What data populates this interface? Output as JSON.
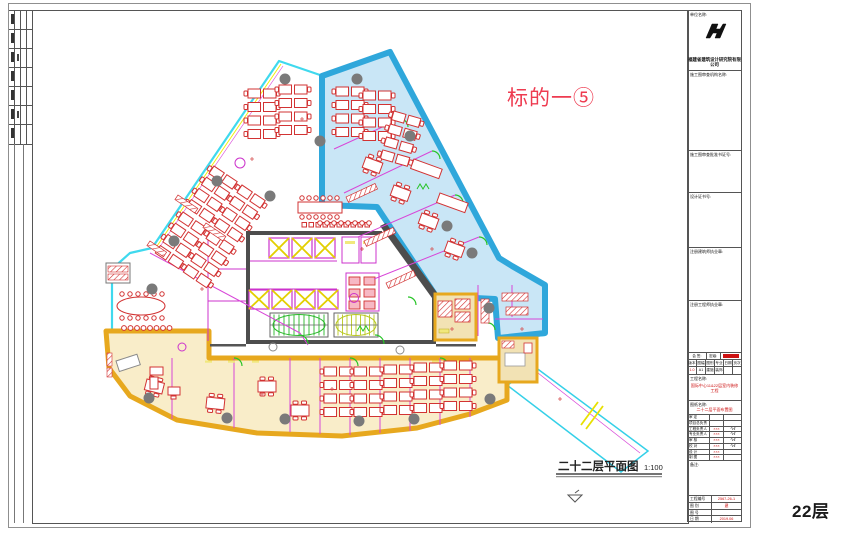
{
  "plan": {
    "title": "二十二层平面图",
    "scale": "1:100",
    "target_label": "标的一⑤",
    "floor_tag": "22层"
  },
  "colors": {
    "highlight_blue_border": "#2fa7db",
    "highlight_blue_fill": "#c9e6f6",
    "highlight_orange_border": "#e7a81e",
    "highlight_orange_fill": "#f9edc9",
    "outline_cyan": "#3fd9ee",
    "furniture_red": "#d23333",
    "partition_magenta": "#cc33cc",
    "annotation_red": "#ee3b50"
  },
  "title_block": {
    "unit_name_label": "单位名称:",
    "company_name": "福建省建筑设计研究院有限公司",
    "review_org_label": "施工图审查机构名称:",
    "review_cert_label": "施工图审查批准书证号:",
    "design_cert_label": "设计证书号:",
    "architect_seal_label": "注册建筑师执业章:",
    "engineer_seal_label": "注册工程师执业章:",
    "sign_label": "会 签:",
    "secrecy_label": "密级:",
    "grid_headers": [
      "版本",
      "图幅",
      "图别",
      "专业",
      "日期",
      "页次"
    ],
    "grid_values": [
      "1.0",
      "A1",
      "建施",
      "装饰",
      "",
      ""
    ],
    "project_name_label": "工程名称:",
    "project_name": "国际中心11&22层室内装修工程",
    "drawing_name_label": "图纸名称:",
    "drawing_name": "二十二层平面布置图",
    "signature_rows": [
      {
        "label": "审  定",
        "value": "",
        "sign": ""
      },
      {
        "label": "项目总负责人",
        "value": "",
        "sign": ""
      },
      {
        "label": "工程负责人",
        "value": "×××",
        "sign": "∿ℓ"
      },
      {
        "label": "专业负责人",
        "value": "×××",
        "sign": "∿ℓ"
      },
      {
        "label": "审  核",
        "value": "×××",
        "sign": "∿ℓ"
      },
      {
        "label": "校  对",
        "value": "×××",
        "sign": "∿ℓ"
      },
      {
        "label": "设  计",
        "value": "×××",
        "sign": ""
      },
      {
        "label": "制  图",
        "value": "×××",
        "sign": ""
      }
    ],
    "note_label": "备注:",
    "footer_rows": [
      {
        "label": "工程编号",
        "value": "2567-26-1"
      },
      {
        "label": "图  别",
        "value": "建"
      },
      {
        "label": "图  号",
        "value": ""
      },
      {
        "label": "日  期",
        "value": "2019.06"
      }
    ]
  }
}
